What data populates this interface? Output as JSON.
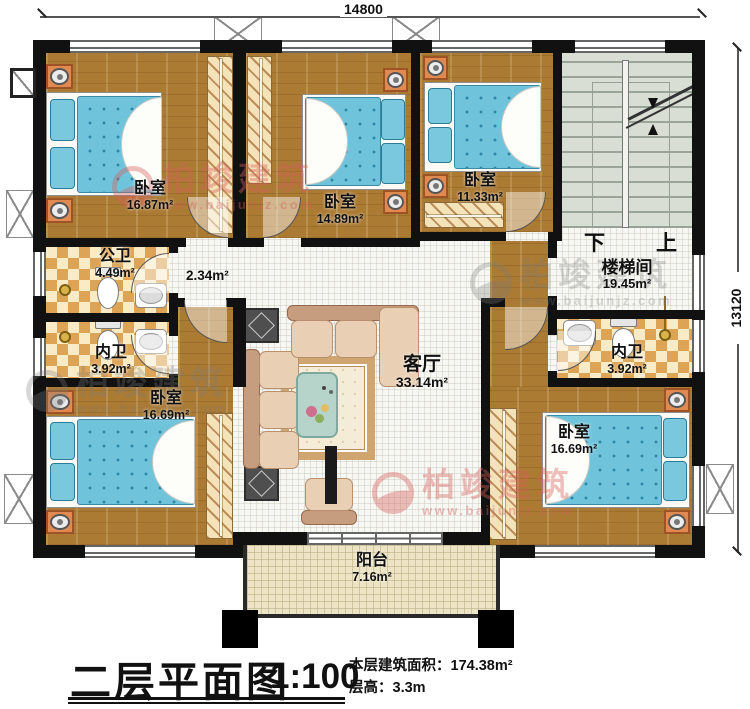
{
  "title_block": {
    "title": "二层平面图",
    "scale": "1:100",
    "area_label": "本层建筑面积：",
    "area_value": "174.38m²",
    "floor_height_label": "层高：",
    "floor_height_value": "3.3m"
  },
  "dimensions": {
    "width_mm": "14800",
    "height_mm": "13120"
  },
  "watermark": {
    "brand": "柏竣建筑",
    "url": "www.baijunjz.com"
  },
  "stair": {
    "down": "下",
    "up": "上"
  },
  "rooms": {
    "bedroom_tl": {
      "name": "卧室",
      "area": "16.87m²"
    },
    "bedroom_tm": {
      "name": "卧室",
      "area": "14.89m²"
    },
    "bedroom_tr": {
      "name": "卧室",
      "area": "11.33m²"
    },
    "stairwell": {
      "name": "楼梯间",
      "area": "19.45m²"
    },
    "public_bath": {
      "name": "公卫",
      "area": "4.49m²"
    },
    "ensuite_left": {
      "name": "内卫",
      "area": "3.92m²"
    },
    "ensuite_right": {
      "name": "内卫",
      "area": "3.92m²"
    },
    "corridor": {
      "area": "2.34m²"
    },
    "living": {
      "name": "客厅",
      "area": "33.14m²"
    },
    "bedroom_bl": {
      "name": "卧室",
      "area": "16.69m²"
    },
    "bedroom_br": {
      "name": "卧室",
      "area": "16.69m²"
    },
    "balcony": {
      "name": "阳台",
      "area": "7.16m²"
    }
  }
}
